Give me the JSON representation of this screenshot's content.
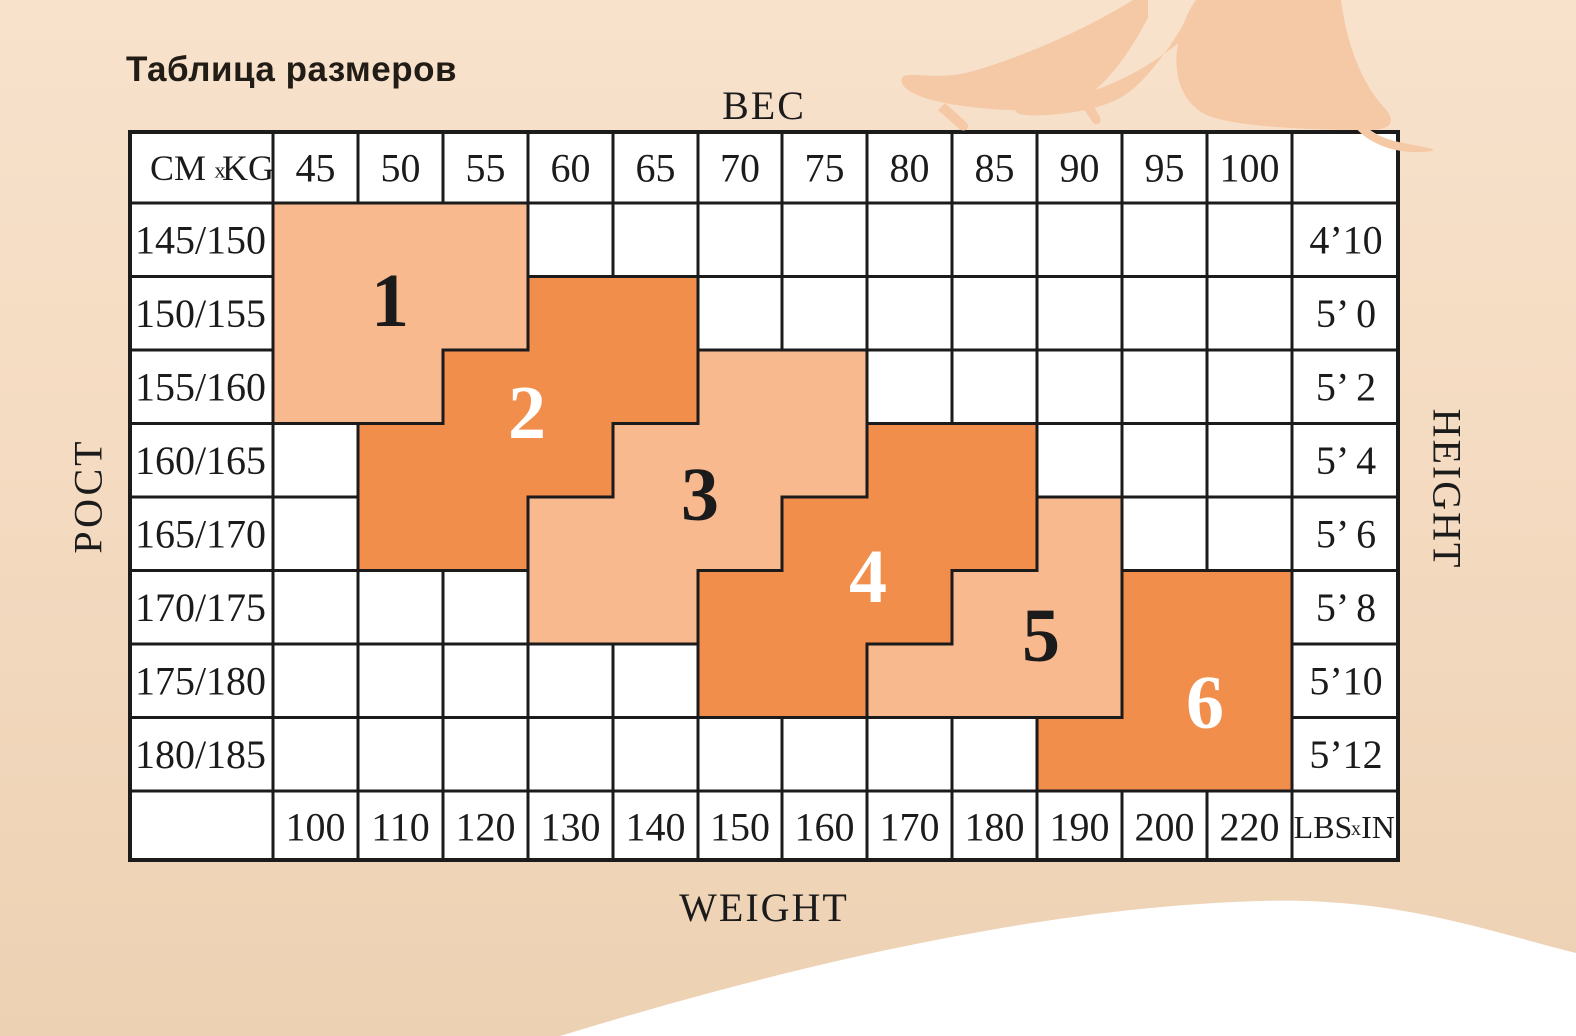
{
  "chart_data": {
    "type": "table",
    "title": "Таблица размеров",
    "x_axis": {
      "label_top": "ВЕС",
      "label_bottom": "WEIGHT",
      "kg": [
        45,
        50,
        55,
        60,
        65,
        70,
        75,
        80,
        85,
        90,
        95,
        100
      ],
      "lbs": [
        100,
        110,
        120,
        130,
        140,
        150,
        160,
        170,
        180,
        190,
        200,
        220
      ]
    },
    "y_axis": {
      "label_left": "РОСТ",
      "label_right": "HEIGHT",
      "cm": [
        "145/150",
        "150/155",
        "155/160",
        "160/165",
        "165/170",
        "170/175",
        "175/180",
        "180/185"
      ],
      "inches": [
        "4’10",
        "5’ 0",
        "5’ 2",
        "5’ 4",
        "5’ 6",
        "5’ 8",
        "5’10",
        "5’12"
      ]
    },
    "units": {
      "metric": [
        "CM",
        "x",
        "KG"
      ],
      "imperial": [
        "LBS",
        "x",
        "IN"
      ]
    },
    "regions": [
      {
        "label": "1",
        "shade": "light",
        "cells": {
          "145/150": [
            45,
            50,
            55
          ],
          "150/155": [
            45,
            50,
            55
          ],
          "155/160": [
            45,
            50
          ]
        }
      },
      {
        "label": "2",
        "shade": "dark",
        "cells": {
          "150/155": [
            60,
            65
          ],
          "155/160": [
            55,
            60,
            65
          ],
          "160/165": [
            50,
            55,
            60
          ],
          "165/170": [
            50,
            55
          ]
        }
      },
      {
        "label": "3",
        "shade": "light",
        "cells": {
          "155/160": [
            70,
            75
          ],
          "160/165": [
            65,
            70,
            75
          ],
          "165/170": [
            60,
            65,
            70
          ],
          "170/175": [
            60,
            65
          ]
        }
      },
      {
        "label": "4",
        "shade": "dark",
        "cells": {
          "160/165": [
            80,
            85
          ],
          "165/170": [
            75,
            80,
            85
          ],
          "170/175": [
            70,
            75,
            80
          ],
          "175/180": [
            70,
            75
          ]
        }
      },
      {
        "label": "5",
        "shade": "light",
        "cells": {
          "165/170": [
            90
          ],
          "170/175": [
            85,
            90
          ],
          "175/180": [
            80,
            85,
            90
          ]
        }
      },
      {
        "label": "6",
        "shade": "dark",
        "cells": {
          "170/175": [
            95,
            100
          ],
          "175/180": [
            95,
            100
          ],
          "180/185": [
            90,
            95,
            100
          ]
        }
      }
    ],
    "colors": {
      "region_light": "#F9B98E",
      "region_dark": "#F18E4C",
      "grid": "#1B1B1B",
      "cell_bg": "#FFFFFF",
      "background_top": "#F8E2CC",
      "background_bottom": "#EDD1B3",
      "silhouette": "#F5C9A6",
      "wave": "#FFFFFF"
    }
  }
}
